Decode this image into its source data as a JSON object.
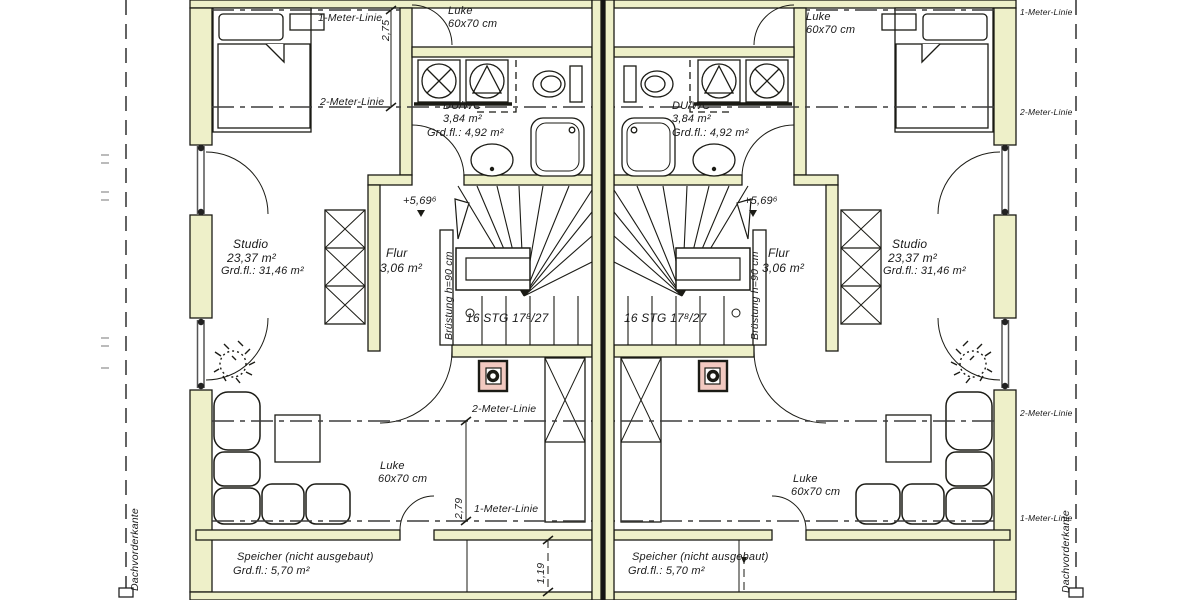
{
  "drawing": {
    "title_hint": "duplex attic floor plan",
    "rooms": {
      "studio": {
        "name": "Studio",
        "area": "23,37 m²",
        "floor_area": "Grd.fl.: 31,46 m²"
      },
      "duwc": {
        "name": "DU/WC",
        "area": "3,84 m²",
        "floor_area": "Grd.fl.: 4,92 m²"
      },
      "flur": {
        "name": "Flur",
        "area": "3,06 m²"
      },
      "speicher": {
        "name": "Speicher (nicht ausgebaut)",
        "floor_area": "Grd.fl.: 5,70 m²"
      }
    },
    "stair": {
      "steps": "16 STG 17⁸/27",
      "parapet": "Brüstung h=90 cm",
      "elevation": "+5,69⁶"
    },
    "hatch": {
      "name": "Luke",
      "size": "60x70 cm"
    },
    "guides": {
      "meter1": "1-Meter-Linie",
      "meter2": "2-Meter-Linie",
      "roof_edge": "Dachvorderkante"
    },
    "dimensions": {
      "d275": "2,75",
      "d279": "2,79",
      "d119": "1,19"
    },
    "colors": {
      "wall": "#eef0c9",
      "outline": "#1b1b15",
      "chimney": "#f2c9c0",
      "dash": "#3d3d3d"
    }
  }
}
